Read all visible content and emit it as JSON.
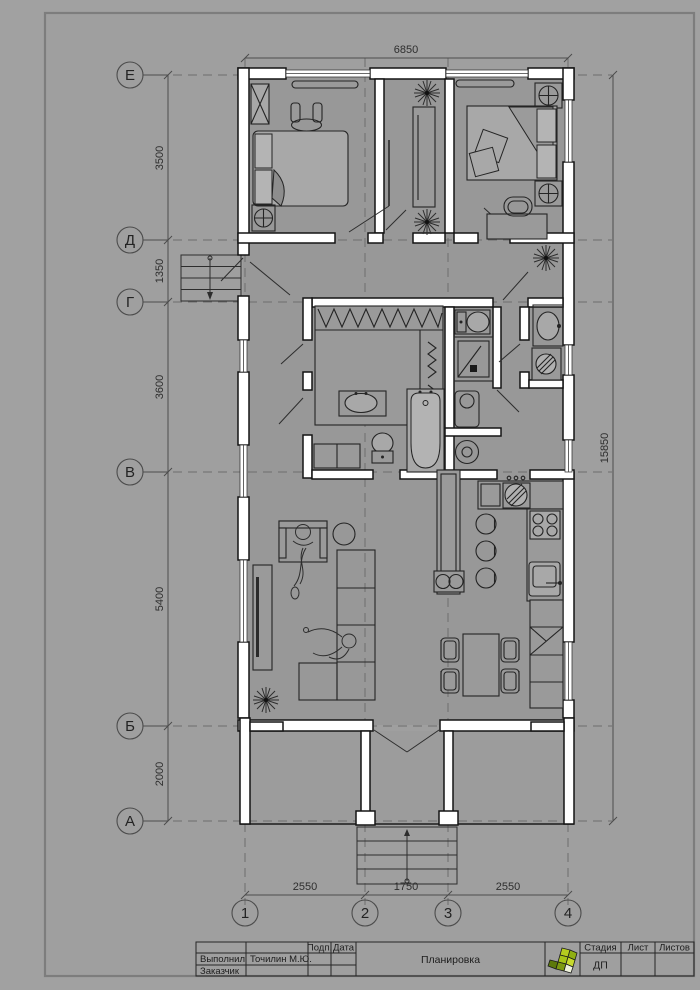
{
  "axes": {
    "rows": [
      {
        "label": "Е"
      },
      {
        "label": "Д"
      },
      {
        "label": "Г"
      },
      {
        "label": "В"
      },
      {
        "label": "Б"
      },
      {
        "label": "А"
      }
    ],
    "cols": [
      {
        "label": "1"
      },
      {
        "label": "2"
      },
      {
        "label": "3"
      },
      {
        "label": "4"
      }
    ]
  },
  "dims": {
    "top": "6850",
    "left": [
      "3500",
      "1350",
      "3600",
      "5400",
      "2000"
    ],
    "right": "15850",
    "bottom": [
      "2550",
      "1750",
      "2550"
    ]
  },
  "title_block": {
    "executor_label": "Выполнил",
    "client_label": "Заказчик",
    "executor_name": "Точилин М.Ю.",
    "sign_label": "Подп.",
    "date_label": "Дата",
    "doc_title": "Планировка",
    "stage_label": "Стадия",
    "sheet_label": "Лист",
    "sheets_label": "Листов",
    "stage_value": "ДП"
  },
  "colors": {
    "page_bg": "#a1a1a1",
    "wall_fill": "#ffffff",
    "line": "#1c1c1c",
    "logo_green": "#9fb914",
    "logo_dark_green": "#6c8a0e",
    "logo_light": "#cfdd3a"
  }
}
